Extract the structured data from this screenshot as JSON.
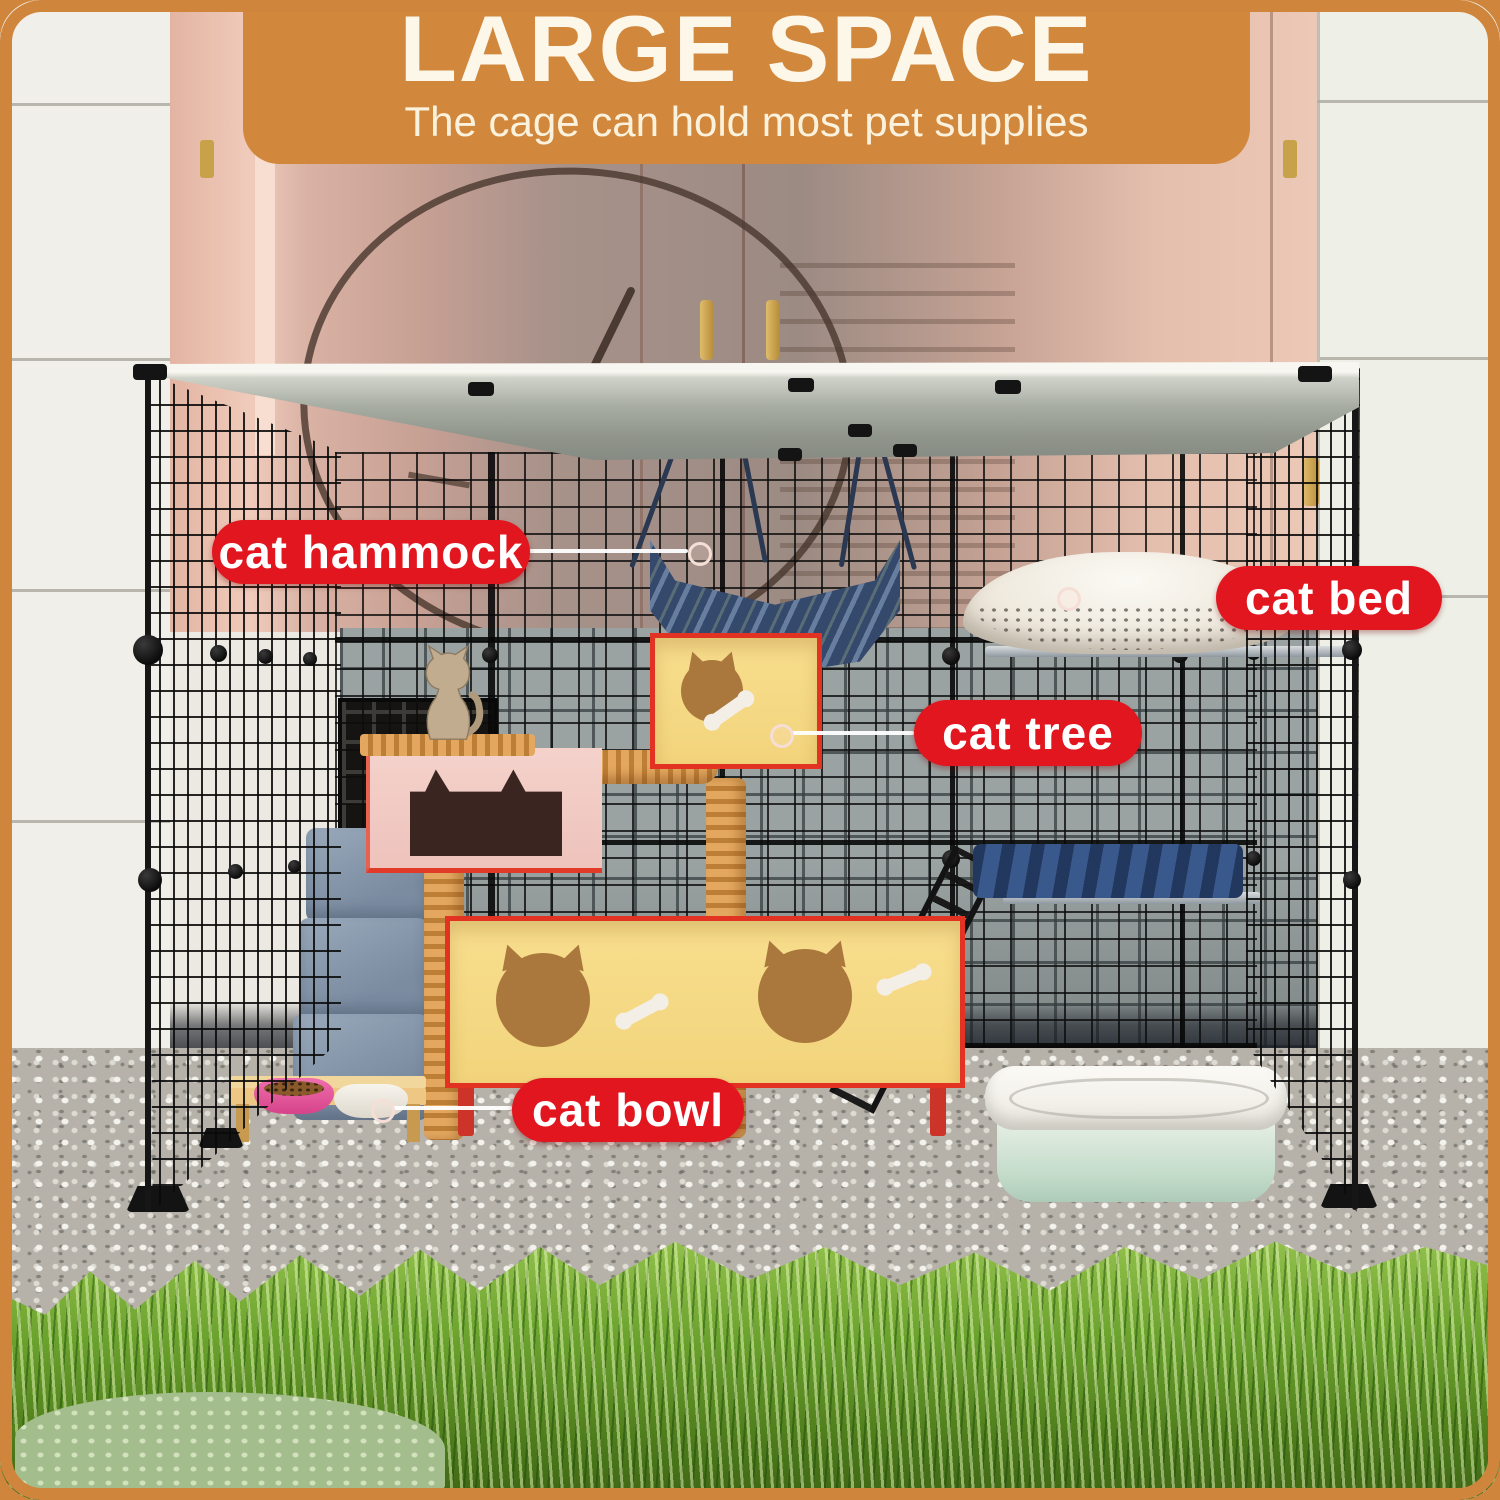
{
  "banner": {
    "title": "LARGE SPACE",
    "subtitle": "The cage can hold most pet supplies"
  },
  "callouts": {
    "hammock": {
      "label": "cat hammock"
    },
    "bed": {
      "label": "cat bed"
    },
    "tree": {
      "label": "cat tree"
    },
    "bowl": {
      "label": "cat bowl"
    }
  },
  "colors": {
    "frame_orange": "#d0853c",
    "banner_bg": "#d1873c",
    "banner_text": "#fdf7e9",
    "callout_bg": "#e1161f",
    "callout_text": "#ffffff"
  }
}
